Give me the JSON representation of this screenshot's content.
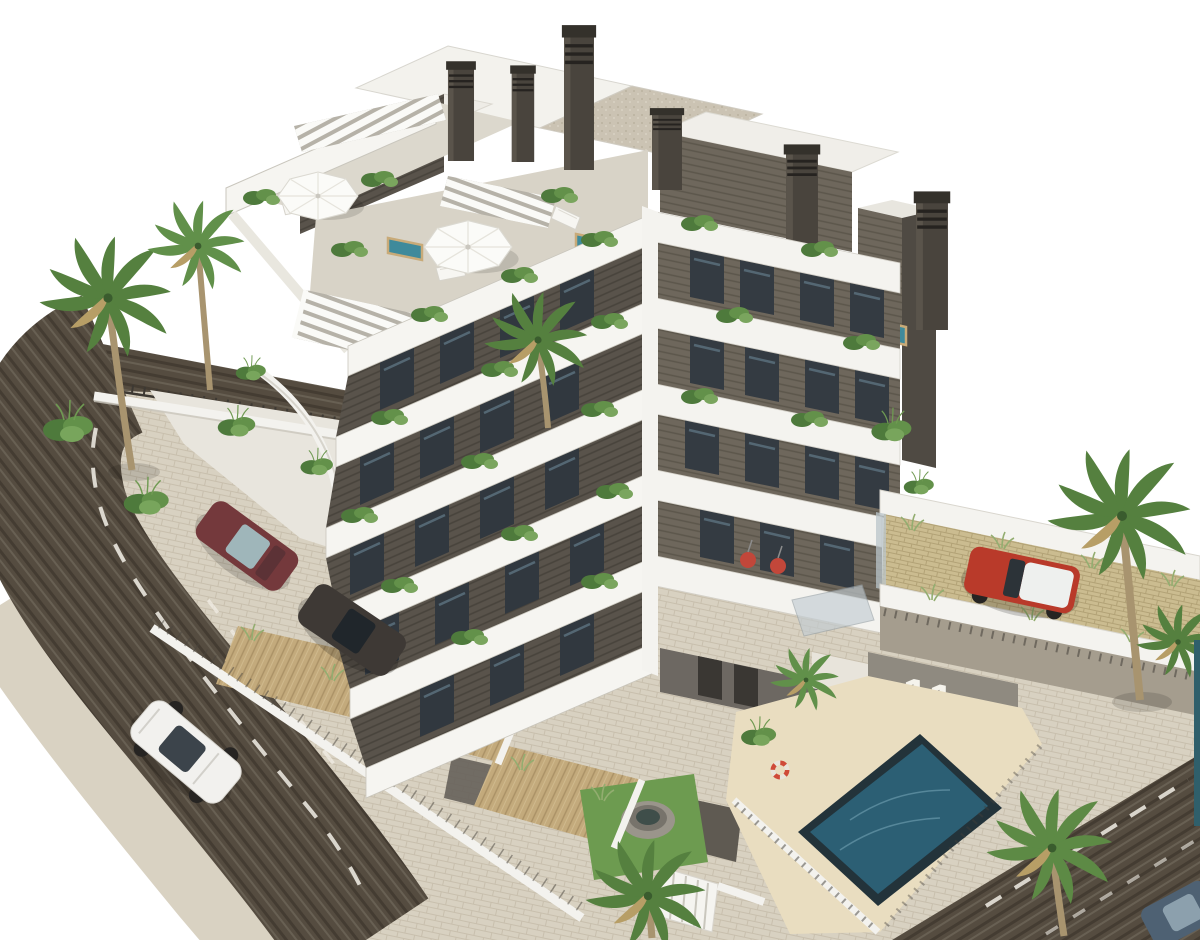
{
  "scene": {
    "title": "3D architectural rendering of a modern apartment complex",
    "setting": "aerial three-quarter view on a plain white background",
    "signage": {
      "building_number": "11"
    },
    "building": {
      "floors_visible": 6,
      "style": "modern white stacked-balcony block with dark timber-slat cladding",
      "roof_features": [
        "chimneys",
        "slatted pergolas",
        "white parasols",
        "plunge pools",
        "sun loungers"
      ],
      "facade_features": [
        "deep white balcony bands",
        "floor-to-ceiling glazing",
        "balcony planters",
        "red hanging chairs"
      ]
    },
    "amenities": {
      "communal_pool": {
        "shape": "rectangular",
        "deck": "sand-colored",
        "lifebuoys": 3
      },
      "rooftop_plunge_pools": 3,
      "private_gardens": {
        "decking": "timber",
        "lawn": true,
        "round_spa": true
      },
      "parking_terrace": {
        "surface": "grass-grid pavers",
        "vehicle": "red SUV with white roof"
      }
    },
    "vehicles": [
      {
        "name": "white-suv-driving",
        "hex": "#f2f1ee",
        "location": "left road"
      },
      {
        "name": "maroon-hatchback",
        "hex": "#74393c",
        "location": "driveway"
      },
      {
        "name": "dark-grey-suv",
        "hex": "#3e3935",
        "location": "carport"
      },
      {
        "name": "red-suv",
        "hex": "#b93a2a",
        "location": "parking terrace"
      },
      {
        "name": "blue-grey-car",
        "hex": "#4e6173",
        "location": "bottom-right corner"
      }
    ],
    "vegetation": {
      "palm_trees": 8,
      "shrubs": "grasses and shrubs along walls, decks and balconies"
    },
    "roads": {
      "layout": "curved road wrapping the left side, diagonal road at bottom-right",
      "asphalt_hex": "#554c40",
      "marking_hex": "#f3f0e7",
      "sidewalk_hex": "#d9d2c2"
    },
    "palette": {
      "background": "#ffffff",
      "white_walls": "#f5f4f0",
      "cladding_dark": "#59534b",
      "cladding_light": "#6e675c",
      "glass": "#31383f",
      "wood_deck": "#c3aa7c",
      "lawn": "#6d9b50",
      "sand_deck": "#e9ddc0",
      "palm_green": "#55803f",
      "pool_water": "#2c5f74",
      "plunge_pool": "#3f8a9b",
      "paver_khaki": "#cbbc90"
    }
  }
}
